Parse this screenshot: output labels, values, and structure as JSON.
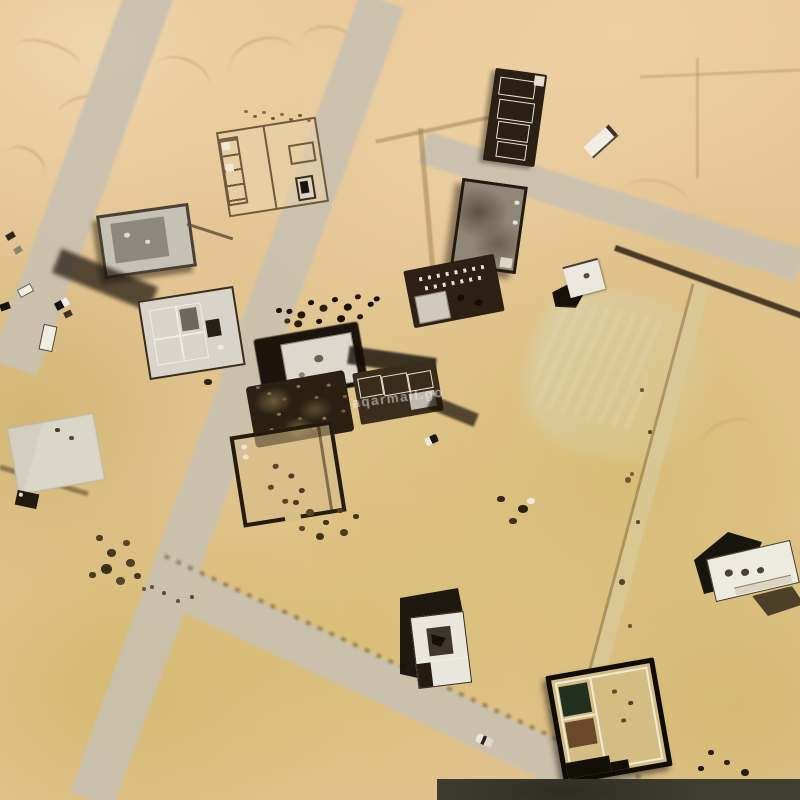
{
  "map": {
    "type": "satellite-imagery",
    "watermark": "aqarmall.go",
    "colors": {
      "sand_light": "#ecd2aa",
      "sand_base": "#e3c493",
      "sand_olive": "#d6bf76",
      "road": "#c9c0af",
      "shadow": "#17110a",
      "roof_white": "#edebe0",
      "roof_gray": "#c6c1b5",
      "wall_dark": "#2a2013",
      "overlay_bar": "#3f3d30"
    },
    "features": [
      {
        "name": "walled-compound-north",
        "kind": "walled plot with rooms"
      },
      {
        "name": "construction-building-north",
        "kind": "building under construction"
      },
      {
        "name": "site-trailer",
        "kind": "portable cabin"
      },
      {
        "name": "construction-building-two",
        "kind": "building under construction"
      },
      {
        "name": "gray-flat-roof-building",
        "kind": "flat-roof building"
      },
      {
        "name": "house-center-left",
        "kind": "house with cast shadow"
      },
      {
        "name": "construction-site-center",
        "kind": "active construction site"
      },
      {
        "name": "walled-compound-center",
        "kind": "walled courtyard"
      },
      {
        "name": "white-building-right",
        "kind": "small white building"
      },
      {
        "name": "white-house-bottom-center",
        "kind": "white villa with shadow"
      },
      {
        "name": "white-house-bottom-right",
        "kind": "white villa with shadow"
      },
      {
        "name": "construction-bottom-right",
        "kind": "villa under construction"
      },
      {
        "name": "concrete-pad",
        "kind": "concrete slab"
      },
      {
        "name": "vehicle-cluster-west",
        "kind": "parked vehicles"
      },
      {
        "name": "car-on-road",
        "kind": "moving car"
      },
      {
        "name": "dirt-roads",
        "kind": "graded desert roads"
      }
    ]
  }
}
